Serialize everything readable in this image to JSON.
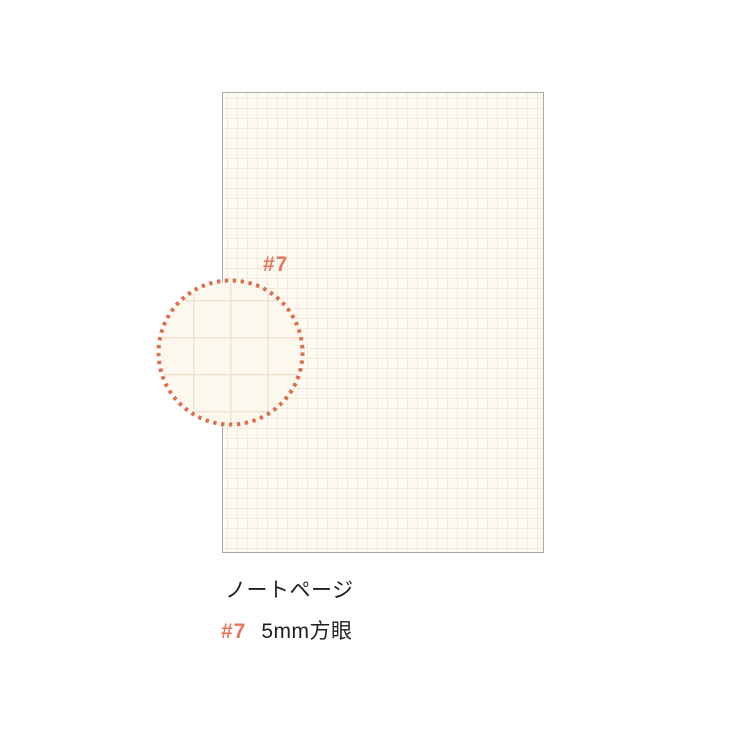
{
  "paper": {
    "kind": "notebook-page-preview",
    "background_color": "#fdfaf2",
    "grid_color": "#f2ebdc",
    "grid_spacing_px": 10,
    "border_color": "#a9a9a9"
  },
  "magnifier": {
    "label": "#7",
    "dot_color": "#df6c4d",
    "background_color": "#fdf8ee",
    "grid_color": "#efe3cf"
  },
  "caption": {
    "title": "ノートページ",
    "item_number": "#7",
    "item_description": "5mm方眼",
    "accent_color": "#e8745a",
    "text_color": "#1f1f1f"
  }
}
